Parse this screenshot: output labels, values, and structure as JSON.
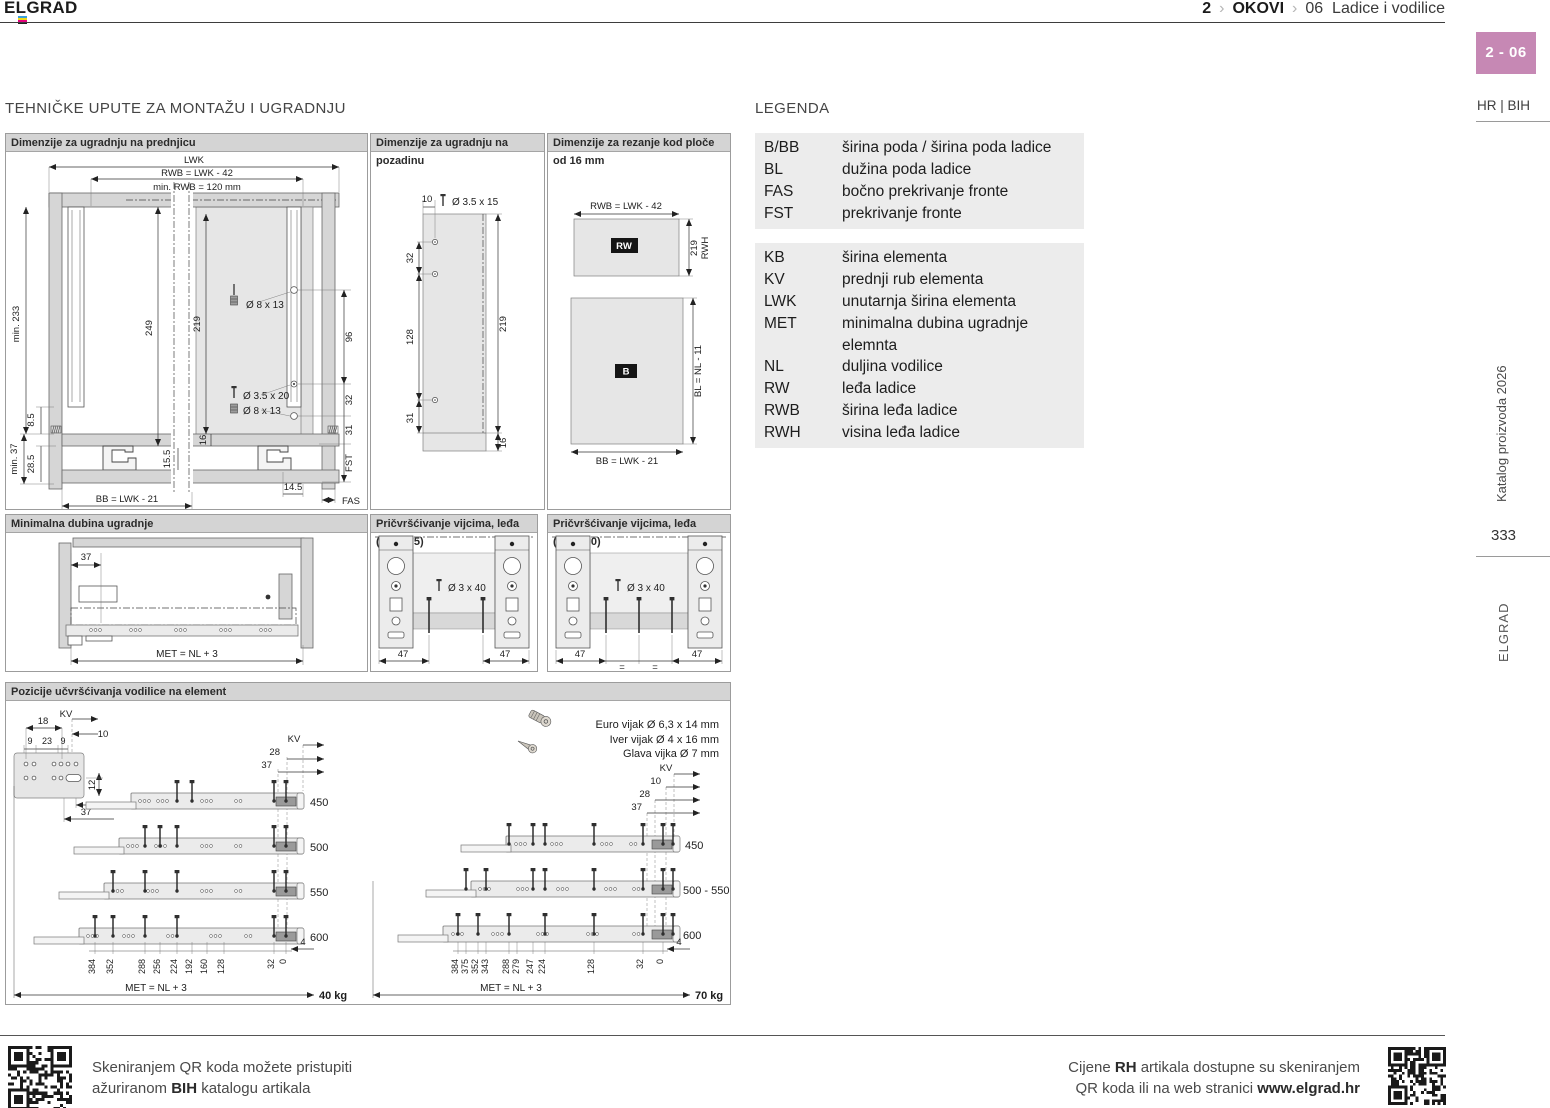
{
  "colors": {
    "badge": "#c688b4",
    "panel_header": "#d4d4d4",
    "legend_bg": "#ececec"
  },
  "header": {
    "brand": "ELGRAD",
    "sep": "›",
    "crumb1": "2",
    "crumb2": "OKOVI",
    "crumb3": "06",
    "crumb3b": "Ladice i vodilice"
  },
  "sidebar": {
    "badge": "2 - 06",
    "lang": "HR | BIH",
    "catalog": "Katalog proizvoda 2026",
    "page": "333",
    "brand": "ELGRAD"
  },
  "main_title": "TEHNIČKE UPUTE ZA MONTAŽU I UGRADNJU",
  "legend": {
    "title": "LEGENDA",
    "groups": [
      {
        "rows": [
          [
            "B/BB",
            "širina poda / širina poda ladice"
          ],
          [
            "BL",
            "dužina poda ladice"
          ],
          [
            "FAS",
            "bočno prekrivanje fronte"
          ],
          [
            "FST",
            "prekrivanje fronte"
          ]
        ]
      },
      {
        "rows": [
          [
            "KB",
            "širina elementa"
          ],
          [
            "KV",
            "prednji rub elementa"
          ],
          [
            "LWK",
            "unutarnja širina elementa"
          ],
          [
            "MET",
            "minimalna dubina ugradnje elemnta"
          ]
        ]
      },
      {
        "rows": [
          [
            "NL",
            "duljina vodilice"
          ],
          [
            "RW",
            "leđa ladice"
          ],
          [
            "RWB",
            "širina leđa ladice"
          ],
          [
            "RWH",
            "visina leđa ladice"
          ]
        ]
      }
    ]
  },
  "d1": {
    "title": "Dimenzije za ugradnju na prednjicu",
    "lwk": "LWK",
    "rwb": "RWB = LWK - 42",
    "minrwb": "min. RWB = 120 mm",
    "min233": "min. 233",
    "n249": "249",
    "n219": "219",
    "n96": "96",
    "n85": "8.5",
    "min37": "min. 37",
    "n285": "28.5",
    "n16": "16",
    "n155": "15.5",
    "dowel1": "Ø 8 x 13",
    "screw1": "Ø 3.5 x 20",
    "dowel2": "Ø 8 x 13",
    "n32": "32",
    "n31": "31",
    "fst": "FST",
    "n145": "14.5",
    "fas": "FAS",
    "bb": "BB = LWK - 21"
  },
  "d2": {
    "title": "Dimenzije za ugradnju na pozadinu",
    "n10": "10",
    "screw": "Ø 3.5 x 15",
    "n32": "32",
    "n128": "128",
    "n31": "31",
    "n219": "219",
    "n16": "16"
  },
  "d3": {
    "title": "Dimenzije za rezanje kod ploče od 16 mm",
    "rwb": "RWB = LWK - 42",
    "rw": "RW",
    "n219": "219",
    "rwh": "RWH",
    "b": "B",
    "bl": "BL = NL - 11",
    "bb": "BB = LWK - 21"
  },
  "d4": {
    "title": "Minimalna dubina ugradnje",
    "n37": "37",
    "met": "MET = NL + 3"
  },
  "d5": {
    "title": "Pričvršćivanje vijcima, leđa (KB≥275)",
    "screw": "Ø 3 x 40",
    "n47a": "47",
    "n47b": "47"
  },
  "d6": {
    "title": "Pričvršćivanje vijcima, leđa (KB≥600)",
    "screw": "Ø 3 x 40",
    "n47a": "47",
    "n47b": "47",
    "eq1": "=",
    "eq2": "="
  },
  "d7": {
    "title": "Pozicije učvršćivanja vodilice na element",
    "detail": {
      "kv": "KV",
      "n18": "18",
      "n10": "10",
      "n9a": "9",
      "n23": "23",
      "n9b": "9",
      "n12": "12",
      "n28": "28",
      "n37": "37"
    },
    "screws": {
      "euro": "Euro vijak Ø 6,3 x 14 mm",
      "iver": "Iver vijak  Ø 4 x 16 mm",
      "glava": "Glava vijka  Ø 7 mm"
    },
    "left": {
      "kv": "KV",
      "n28": "28",
      "n37": "37",
      "lengths": [
        "450",
        "500",
        "550",
        "600"
      ],
      "scale": [
        "384",
        "352",
        "288",
        "256",
        "224",
        "192",
        "160",
        "128",
        "32",
        "0"
      ],
      "n4": "4",
      "met": "MET = NL + 3",
      "load": "40 kg"
    },
    "right": {
      "kv": "KV",
      "n10": "10",
      "n28": "28",
      "n37": "37",
      "lengths": [
        "450",
        "500 - 550",
        "600"
      ],
      "scale": [
        "384",
        "375",
        "352",
        "343",
        "288",
        "279",
        "247",
        "224",
        "128",
        "32",
        "0"
      ],
      "n4": "4",
      "met": "MET = NL + 3",
      "load": "70 kg"
    }
  },
  "footer": {
    "l1": "Skeniranjem QR koda možete pristupiti",
    "l2a": "ažuriranom ",
    "l2b": "BIH",
    "l2c": " katalogu artikala",
    "r1a": "Cijene ",
    "r1b": "RH",
    "r1c": " artikala dostupne su skeniranjem",
    "r2a": "QR koda ili na web stranici ",
    "r2b": "www.elgrad.hr"
  }
}
